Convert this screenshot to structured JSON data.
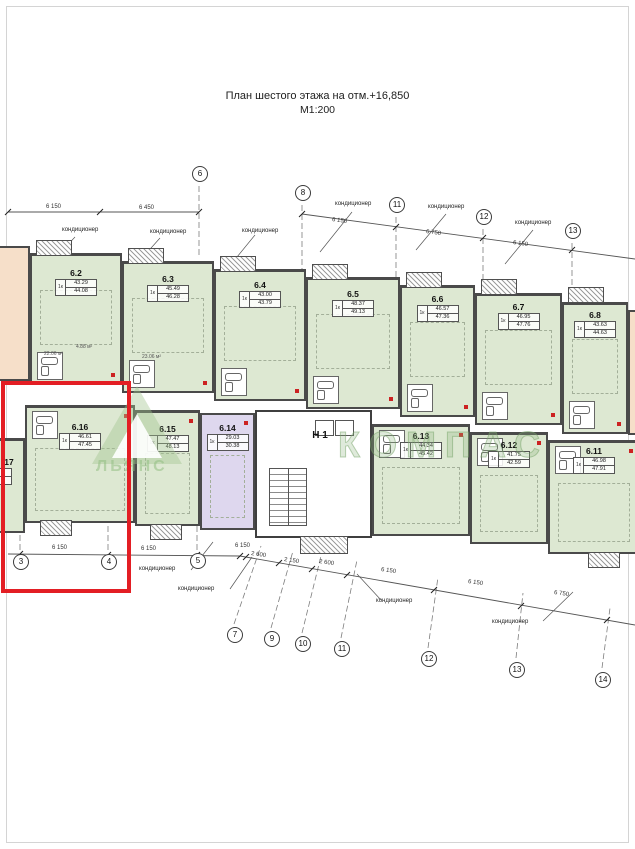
{
  "title": {
    "text": "План шестого этажа на отм.+16,850",
    "scale": "М1:200"
  },
  "watermarks": {
    "brand_outline": "КОМПАС",
    "brand_text": "ЛЬЯНС"
  },
  "labels": {
    "ac": "кондиционер",
    "core": "Н 1",
    "partial_left_unit": "17"
  },
  "units": {
    "u6_2": {
      "id": "6.2",
      "type": "1к",
      "area_living": "43.29",
      "area_total": "44.08"
    },
    "u6_3": {
      "id": "6.3",
      "type": "1к",
      "area_living": "45.49",
      "area_total": "46.28"
    },
    "u6_4": {
      "id": "6.4",
      "type": "1к",
      "area_living": "43.00",
      "area_total": "43.79"
    },
    "u6_5": {
      "id": "6.5",
      "type": "1к",
      "area_living": "48.37",
      "area_total": "49.13"
    },
    "u6_6": {
      "id": "6.6",
      "type": "1к",
      "area_living": "46.57",
      "area_total": "47.36"
    },
    "u6_7": {
      "id": "6.7",
      "type": "1к",
      "area_living": "46.95",
      "area_total": "47.76"
    },
    "u6_8": {
      "id": "6.8",
      "type": "1к",
      "area_living": "43.63",
      "area_total": "44.63"
    },
    "u6_11": {
      "id": "6.11",
      "type": "1к",
      "area_living": "46.98",
      "area_total": "47.91"
    },
    "u6_12": {
      "id": "6.12",
      "type": "1к",
      "area_living": "41.75",
      "area_total": "42.59"
    },
    "u6_13": {
      "id": "6.13",
      "type": "1к",
      "area_living": "44.34",
      "area_total": "45.42"
    },
    "u6_14": {
      "id": "6.14",
      "type": "1к",
      "area_living": "29.03",
      "area_total": "30.38"
    },
    "u6_15": {
      "id": "6.15",
      "type": "1к",
      "area_living": "47.47",
      "area_total": "48.13"
    },
    "u6_16": {
      "id": "6.16",
      "type": "1к",
      "area_living": "46.61",
      "area_total": "47.45"
    }
  },
  "axes": {
    "top": [
      "6",
      "8",
      "11",
      "12",
      "13"
    ],
    "bottom": [
      "3",
      "4",
      "5",
      "7",
      "9",
      "10",
      "11",
      "12",
      "13",
      "14"
    ]
  },
  "dimensions": {
    "top": [
      "6 150",
      "6 450",
      "6 150",
      "6 750",
      "6 150"
    ],
    "bottom": [
      "6 150",
      "6 150",
      "6 150",
      "2 600",
      "2 150",
      "2 600",
      "6 150",
      "6 150",
      "6 750"
    ]
  },
  "room_areas": [
    "22.06 м²",
    "23.06 м²",
    "4.88 м²"
  ],
  "colors": {
    "unit_green": "#dde8d2",
    "unit_violet": "#ded7ee",
    "unit_orange": "#f6dfc9",
    "highlight": "#e31e24"
  }
}
